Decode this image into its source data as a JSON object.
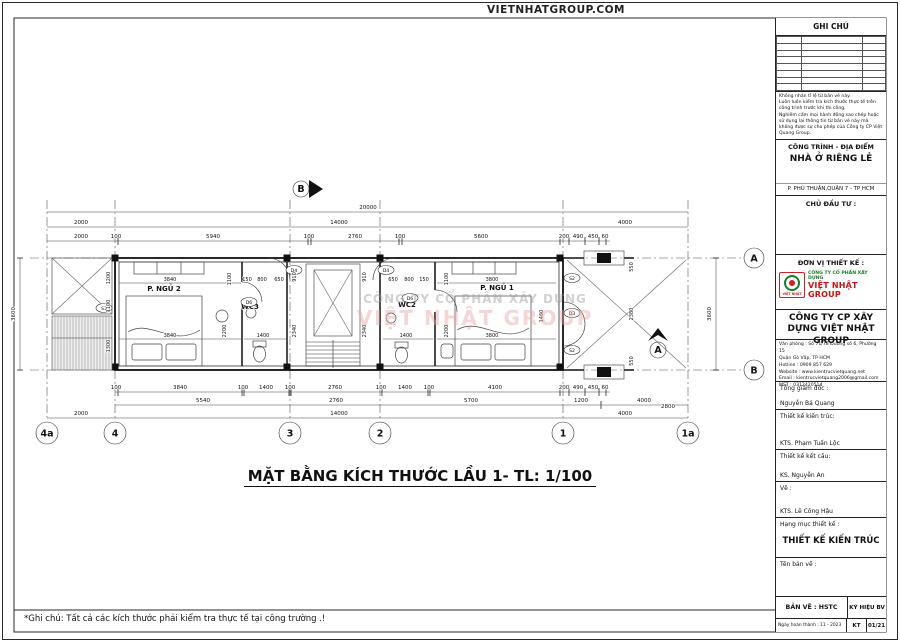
{
  "banner": {
    "site_label": "VIETNHATGROUP.COM"
  },
  "plan": {
    "title": "MẶT BẰNG KÍCH THƯỚC LẦU 1- TL: 1/100",
    "footnote": "*Ghi chú: Tất cả các kích thước phải kiểm tra thực tế tại công trường .!",
    "watermark_line1": "CÔNG TY CỔ PHẦN XÂY DỰNG",
    "watermark_line2": "VIỆT NHẬT GROUP",
    "rooms": {
      "bedroom2": "P. NGỦ 2",
      "wc3": "WC3",
      "wc2": "WC2",
      "bedroom1": "P. NGỦ 1"
    },
    "grid_cols": [
      "4a",
      "4",
      "3",
      "2",
      "1",
      "1a"
    ],
    "grid_rows": [
      "A",
      "B"
    ],
    "section_markers": {
      "a": "A",
      "b": "B"
    },
    "tags": {
      "s1": "S1",
      "d4": "D4",
      "d6": "D6",
      "s2": "S2",
      "d3": "D3"
    },
    "dims": {
      "overall": "20000",
      "top_mid": [
        "2000",
        "14000",
        "4000"
      ],
      "top_detail": [
        "2000",
        "100",
        "5940",
        "100",
        "2760",
        "100",
        "5600",
        "200",
        "490",
        "450",
        "60"
      ],
      "bottom_detail": [
        "100",
        "3840",
        "100",
        "1400",
        "100",
        "2760",
        "100",
        "1400",
        "100",
        "4100",
        "200",
        "490",
        "450",
        "60"
      ],
      "bottom_mid": [
        "5540",
        "2760",
        "5700",
        "1200",
        "4000",
        "2800"
      ],
      "bottom_overall": [
        "2000",
        "14000",
        "4000"
      ],
      "height_left": "3600",
      "height_right": "3600",
      "interior": {
        "v1": "1200",
        "v2": "1100",
        "v3": "1300",
        "v4": "1100",
        "v5": "2200",
        "v6": "910",
        "v7": "2340",
        "v8": "910",
        "v9": "2340",
        "v10": "1100",
        "v11": "2200",
        "v12": "1460",
        "v13": "550",
        "v14": "2380",
        "v15": "550",
        "h1": "3840",
        "h2": "3840",
        "h3": "150",
        "h4": "800",
        "h5": "650",
        "h6": "1400",
        "h7": "650",
        "h8": "800",
        "h9": "150",
        "h10": "1400",
        "h11": "3800",
        "h12": "3800"
      }
    }
  },
  "titleblock": {
    "ghi_chu": "GHI CHÚ",
    "notes": [
      "Không nhân tỉ lệ từ bản vẽ này.",
      "Luôn luôn kiểm tra kích thước thực tế trên công trình trước khi thi công.",
      "Nghiêm cấm mọi hành động sao chép hoặc sử dụng lại thông tin từ bản vẽ này mà không được sự cho phép của Công ty CP Việt Quang Group."
    ],
    "project_header": "CÔNG TRÌNH - ĐỊA ĐIỂM",
    "project_name": "NHÀ Ở RIÊNG LẺ",
    "project_address": "P. PHÚ THUẬN,QUẬN 7 - TP HCM",
    "investor_label": "CHỦ ĐẦU TƯ :",
    "designer_label": "ĐƠN VỊ THIẾT KẾ :",
    "logo_company_line1": "CÔNG TY CỔ PHẦN XÂY DỰNG",
    "logo_company_line2": "VIỆT NHẬT GROUP",
    "logo_badge": "VIỆT NHẬT",
    "company_name": "CÔNG TY CP XÂY DỰNG VIỆT NHẬT GROUP",
    "contact": [
      "Văn phòng : Số 71/78 Đường số 6, Phường 15",
      "Quận Gò Vấp, TP HCM",
      "Hotline : 0909 857 629",
      "Website : www.kientrucvietquang.net",
      "Email : kientrucvietquang2006@gmail.com",
      "MST : 0312420514"
    ],
    "director_label": "Tổng giám đốc :",
    "director_name": "Nguyễn Bá Quang",
    "arch_label": "Thiết kế kiến trúc:",
    "arch_name": "KTS. Phạm Tuấn Lộc",
    "struct_label": "Thiết kế kết cấu:",
    "struct_name": "KS. Nguyễn An",
    "draw_label": "Vẽ :",
    "draw_name": "KTS. Lê Công Hậu",
    "category_label": "Hạng mục thiết kế :",
    "category_value": "THIẾT KẾ KIẾN TRÚC",
    "sheet_name_label": "Tên bản vẽ :",
    "sheet_type": "BẢN VẼ : HSTC",
    "sheet_symbol_label": "KÝ HIỆU BV",
    "date_finished": "Ngày hoàn thành : 11 - 2023",
    "kt_code": "KT",
    "sheet_code": "01/21",
    "colors": {
      "brand_red": "#cc1111",
      "brand_green": "#1a7a2a"
    }
  }
}
